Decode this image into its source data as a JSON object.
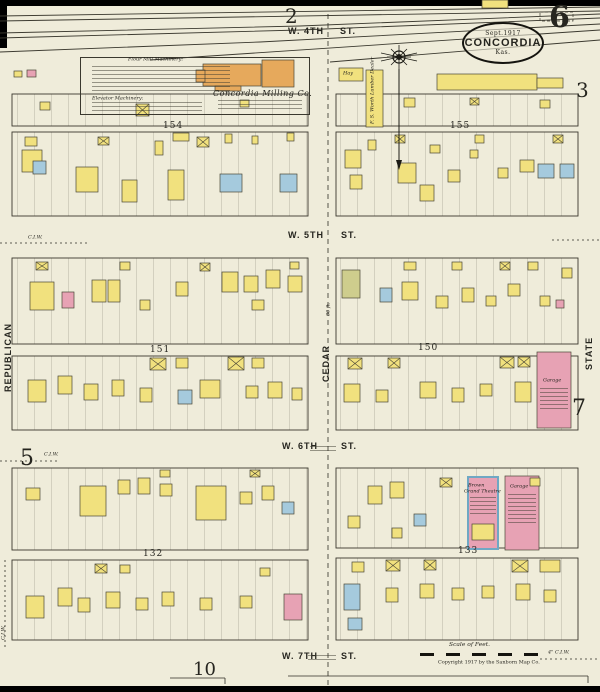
{
  "colors": {
    "paper": "#efecda",
    "ink": "#26251f",
    "frame_yellow": "#f1e17e",
    "brick_pink": "#e7a2b4",
    "stone_blue": "#a5cadd",
    "mill_orange": "#e6a95c",
    "special_olive": "#cecd8d",
    "theatre_stone": "#6fa8c4"
  },
  "titles": {
    "sheet_number": "6",
    "adjoining": {
      "top": "2",
      "right_top": "3",
      "right_mid": "7",
      "left_mid": "5",
      "bottom": "10"
    }
  },
  "stamp": {
    "date": "Sept.1917",
    "city": "CONCORDIA",
    "state": "Kas."
  },
  "streets": {
    "w4th": {
      "name": "W. 4TH",
      "suffix": "ST."
    },
    "w5th": {
      "name": "W. 5TH",
      "suffix": "ST."
    },
    "w6th": {
      "name": "W. 6TH",
      "suffix": "ST."
    },
    "w7th": {
      "name": "W. 7TH",
      "suffix": "ST."
    },
    "republican": "REPUBLICAN",
    "cedar": "CEDAR",
    "state": "STATE",
    "cedar_width": "80 ft."
  },
  "blocks": {
    "b154": "154",
    "b155": "155",
    "b151": "151",
    "b150": "150",
    "b132": "132",
    "b133": "133"
  },
  "labels": {
    "milling_co": "Concordia Milling Co.",
    "flour_mill": "Flour Mill Machinery:",
    "elevator": "Elevator Machinery:",
    "hay": "Hay",
    "worth_lumber": "F. S. Worth Lumber Dealer",
    "theatre_l1": "Brown",
    "theatre_l2": "Grand Theatre",
    "garage_state": "Garage",
    "garage_133": "Garage",
    "scale": "Scale of Feet.",
    "copyright": "Copyright 1917 by the Sanborn Map Co.",
    "ciw": "C.I.W.",
    "ciw4": "4\" C.I.W."
  },
  "buildings": [
    [
      482,
      0,
      26,
      8,
      "y"
    ],
    [
      203,
      64,
      58,
      22,
      "o"
    ],
    [
      262,
      60,
      32,
      27,
      "o"
    ],
    [
      215,
      86,
      26,
      5,
      "o"
    ],
    [
      196,
      70,
      9,
      12,
      "o"
    ],
    [
      339,
      68,
      24,
      13,
      "y"
    ],
    [
      366,
      70,
      17,
      57,
      "y"
    ],
    [
      437,
      74,
      100,
      16,
      "y"
    ],
    [
      537,
      78,
      26,
      10,
      "y"
    ],
    [
      27,
      70,
      9,
      7,
      "p"
    ],
    [
      14,
      71,
      8,
      6,
      "y"
    ],
    [
      40,
      102,
      10,
      8,
      "y"
    ],
    [
      136,
      104,
      13,
      12,
      "y",
      1
    ],
    [
      240,
      100,
      9,
      7,
      "y"
    ],
    [
      25,
      137,
      12,
      9,
      "y"
    ],
    [
      22,
      150,
      20,
      22,
      "y"
    ],
    [
      33,
      161,
      13,
      13,
      "b"
    ],
    [
      76,
      167,
      22,
      25,
      "y"
    ],
    [
      98,
      137,
      11,
      8,
      "y",
      1
    ],
    [
      122,
      180,
      15,
      22,
      "y"
    ],
    [
      155,
      141,
      8,
      14,
      "y"
    ],
    [
      168,
      170,
      16,
      30,
      "y"
    ],
    [
      173,
      133,
      16,
      8,
      "y"
    ],
    [
      197,
      137,
      12,
      10,
      "y",
      1
    ],
    [
      220,
      174,
      22,
      18,
      "b"
    ],
    [
      225,
      134,
      7,
      9,
      "y"
    ],
    [
      252,
      136,
      6,
      8,
      "y"
    ],
    [
      280,
      174,
      17,
      18,
      "b"
    ],
    [
      287,
      133,
      7,
      8,
      "y"
    ],
    [
      404,
      98,
      11,
      9,
      "y"
    ],
    [
      470,
      98,
      9,
      7,
      "y",
      1
    ],
    [
      540,
      100,
      10,
      8,
      "y"
    ],
    [
      345,
      150,
      16,
      18,
      "y"
    ],
    [
      350,
      175,
      12,
      14,
      "y"
    ],
    [
      368,
      140,
      8,
      10,
      "y"
    ],
    [
      395,
      135,
      10,
      8,
      "y",
      1
    ],
    [
      398,
      163,
      18,
      20,
      "y"
    ],
    [
      420,
      185,
      14,
      16,
      "y"
    ],
    [
      430,
      145,
      10,
      8,
      "y"
    ],
    [
      448,
      170,
      12,
      12,
      "y"
    ],
    [
      470,
      150,
      8,
      8,
      "y"
    ],
    [
      475,
      135,
      9,
      8,
      "y"
    ],
    [
      498,
      168,
      10,
      10,
      "y"
    ],
    [
      520,
      160,
      14,
      12,
      "y"
    ],
    [
      538,
      164,
      16,
      14,
      "b"
    ],
    [
      560,
      164,
      14,
      14,
      "b"
    ],
    [
      553,
      135,
      10,
      8,
      "y",
      1
    ],
    [
      30,
      282,
      24,
      28,
      "y"
    ],
    [
      62,
      292,
      12,
      16,
      "p"
    ],
    [
      92,
      280,
      14,
      22,
      "y"
    ],
    [
      108,
      280,
      12,
      22,
      "y"
    ],
    [
      140,
      300,
      10,
      10,
      "y"
    ],
    [
      176,
      282,
      12,
      14,
      "y"
    ],
    [
      222,
      272,
      16,
      20,
      "y"
    ],
    [
      244,
      276,
      14,
      16,
      "y"
    ],
    [
      266,
      270,
      14,
      18,
      "y"
    ],
    [
      288,
      276,
      14,
      16,
      "y"
    ],
    [
      252,
      300,
      12,
      10,
      "y"
    ],
    [
      36,
      262,
      12,
      8,
      "y",
      1
    ],
    [
      120,
      262,
      10,
      8,
      "y"
    ],
    [
      200,
      263,
      10,
      8,
      "y",
      1
    ],
    [
      290,
      262,
      9,
      7,
      "y"
    ],
    [
      150,
      358,
      16,
      12,
      "y",
      1
    ],
    [
      176,
      358,
      12,
      10,
      "y"
    ],
    [
      228,
      357,
      16,
      13,
      "y",
      1
    ],
    [
      252,
      358,
      12,
      10,
      "y"
    ],
    [
      28,
      380,
      18,
      22,
      "y"
    ],
    [
      58,
      376,
      14,
      18,
      "y"
    ],
    [
      84,
      384,
      14,
      16,
      "y"
    ],
    [
      112,
      380,
      12,
      16,
      "y"
    ],
    [
      140,
      388,
      12,
      14,
      "y"
    ],
    [
      178,
      390,
      14,
      14,
      "b"
    ],
    [
      200,
      380,
      20,
      18,
      "y"
    ],
    [
      246,
      386,
      12,
      12,
      "y"
    ],
    [
      268,
      382,
      14,
      16,
      "y"
    ],
    [
      292,
      388,
      10,
      12,
      "y"
    ],
    [
      342,
      270,
      18,
      28,
      "g"
    ],
    [
      380,
      288,
      12,
      14,
      "b"
    ],
    [
      402,
      282,
      16,
      18,
      "y"
    ],
    [
      404,
      262,
      12,
      8,
      "y"
    ],
    [
      436,
      296,
      12,
      12,
      "y"
    ],
    [
      452,
      262,
      10,
      8,
      "y"
    ],
    [
      462,
      288,
      12,
      14,
      "y"
    ],
    [
      486,
      296,
      10,
      10,
      "y"
    ],
    [
      500,
      262,
      10,
      8,
      "y",
      1
    ],
    [
      508,
      284,
      12,
      12,
      "y"
    ],
    [
      528,
      262,
      10,
      8,
      "y"
    ],
    [
      540,
      296,
      10,
      10,
      "y"
    ],
    [
      556,
      300,
      8,
      8,
      "p"
    ],
    [
      562,
      268,
      10,
      10,
      "y"
    ],
    [
      348,
      358,
      14,
      11,
      "y",
      1
    ],
    [
      388,
      358,
      12,
      10,
      "y",
      1
    ],
    [
      500,
      357,
      14,
      11,
      "y",
      1
    ],
    [
      518,
      357,
      12,
      10,
      "y",
      1
    ],
    [
      344,
      384,
      16,
      18,
      "y"
    ],
    [
      376,
      390,
      12,
      12,
      "y"
    ],
    [
      420,
      382,
      16,
      16,
      "y"
    ],
    [
      452,
      388,
      12,
      14,
      "y"
    ],
    [
      480,
      384,
      12,
      12,
      "y"
    ],
    [
      515,
      382,
      16,
      20,
      "y"
    ],
    [
      537,
      352,
      34,
      76,
      "p"
    ],
    [
      26,
      488,
      14,
      12,
      "y"
    ],
    [
      80,
      486,
      26,
      30,
      "y"
    ],
    [
      118,
      480,
      12,
      14,
      "y"
    ],
    [
      138,
      478,
      12,
      16,
      "y"
    ],
    [
      160,
      484,
      12,
      12,
      "y"
    ],
    [
      196,
      486,
      30,
      34,
      "y"
    ],
    [
      240,
      492,
      12,
      12,
      "y"
    ],
    [
      262,
      486,
      12,
      14,
      "y"
    ],
    [
      282,
      502,
      12,
      12,
      "b"
    ],
    [
      160,
      470,
      10,
      7,
      "y"
    ],
    [
      250,
      470,
      10,
      7,
      "y",
      1
    ],
    [
      95,
      564,
      12,
      9,
      "y",
      1
    ],
    [
      120,
      565,
      10,
      8,
      "y"
    ],
    [
      26,
      596,
      18,
      22,
      "y"
    ],
    [
      58,
      588,
      14,
      18,
      "y"
    ],
    [
      78,
      598,
      12,
      14,
      "y"
    ],
    [
      106,
      592,
      14,
      16,
      "y"
    ],
    [
      136,
      598,
      12,
      12,
      "y"
    ],
    [
      162,
      592,
      12,
      14,
      "y"
    ],
    [
      200,
      598,
      12,
      12,
      "y"
    ],
    [
      240,
      596,
      12,
      12,
      "y"
    ],
    [
      284,
      594,
      18,
      26,
      "p"
    ],
    [
      260,
      568,
      10,
      8,
      "y"
    ],
    [
      348,
      516,
      12,
      12,
      "y"
    ],
    [
      368,
      486,
      14,
      18,
      "y"
    ],
    [
      390,
      482,
      14,
      16,
      "y"
    ],
    [
      414,
      514,
      12,
      12,
      "b"
    ],
    [
      392,
      528,
      10,
      10,
      "y"
    ],
    [
      440,
      478,
      12,
      9,
      "y",
      1
    ],
    [
      468,
      477,
      30,
      72,
      "p",
      "s"
    ],
    [
      472,
      524,
      22,
      16,
      "y"
    ],
    [
      505,
      476,
      34,
      74,
      "p"
    ],
    [
      530,
      478,
      10,
      8,
      "y"
    ],
    [
      352,
      562,
      12,
      10,
      "y"
    ],
    [
      386,
      560,
      14,
      11,
      "y",
      1
    ],
    [
      424,
      560,
      12,
      10,
      "y",
      1
    ],
    [
      512,
      560,
      16,
      12,
      "y",
      1
    ],
    [
      540,
      560,
      20,
      12,
      "y"
    ],
    [
      344,
      584,
      16,
      26,
      "b"
    ],
    [
      348,
      618,
      14,
      12,
      "b"
    ],
    [
      386,
      588,
      12,
      14,
      "y"
    ],
    [
      420,
      584,
      14,
      14,
      "y"
    ],
    [
      452,
      588,
      12,
      12,
      "y"
    ],
    [
      482,
      586,
      12,
      12,
      "y"
    ],
    [
      516,
      584,
      14,
      16,
      "y"
    ],
    [
      544,
      590,
      12,
      12,
      "y"
    ]
  ]
}
